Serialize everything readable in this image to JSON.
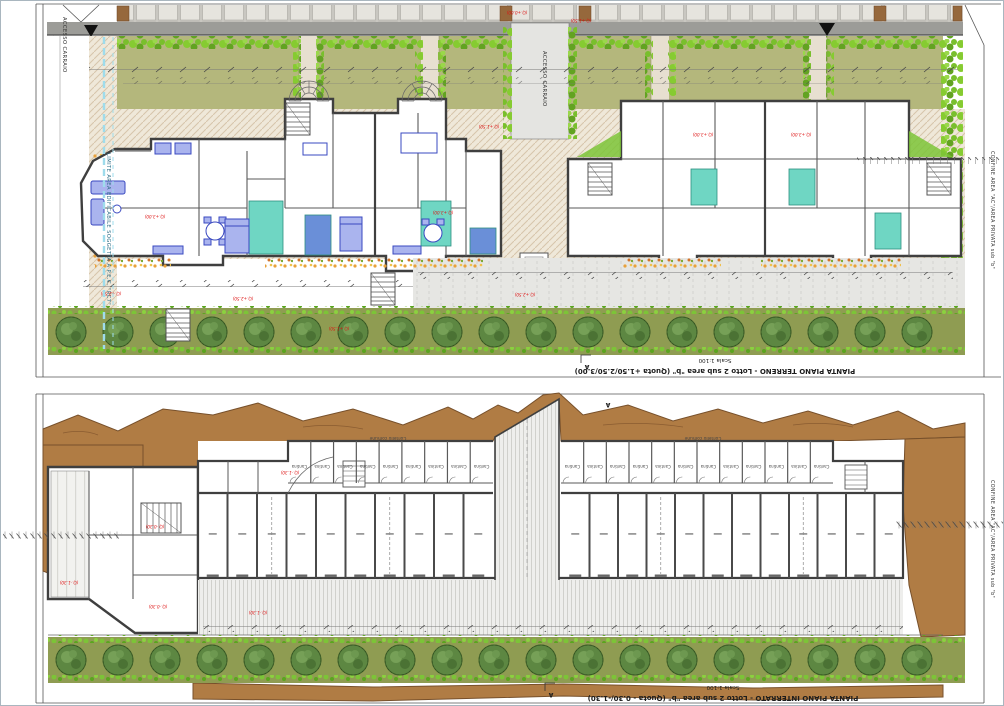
{
  "panels": {
    "top": {
      "title": "PIANTA PIANO TERRENO - Lotto 2 sub area \"b\" (Quota +1.50/2.50/3.00)",
      "scale": "Scala 1:100",
      "section_letter": "A",
      "limit_label": "LIMITE AREA EDIFICABILE SOGGETTA A P.E.C. \"RC7\"",
      "boundary_label": "CONFINE AREA \"AC\"/AREA PRIVATA sub \"b\"",
      "access_left": "ACCESSO CARRAIO",
      "access_center": "ACCESSO CARRAIO",
      "quota_street": "(Q.+0.00)",
      "quota_garden": "(Q.+1.50)",
      "quota_terrace": "(Q.+2.50)",
      "quota_floor": "(Q.+3.00)"
    },
    "bottom": {
      "title": "PIANTA PIANO INTERRATO - Lotto 2 sub area \"b\" (Quota - 0.30/-1.30)",
      "scale": "Scala 1:100",
      "section_letter": "A",
      "boundary_label": "CONFINE AREA \"AC\"/AREA PRIVATA sub \"b\"",
      "cantina_label": "Cantina",
      "corridor_label": "Corsello comune",
      "quota_taverna": "(Q.-0.30)",
      "quota_garage": "(Q.-1.30)"
    },
    "colors": {
      "garden": "#b4b77c",
      "tree_band": "#8f9c52",
      "shrub_green": "#7cc437",
      "tree_green": "#5d8742",
      "road_grey": "#9c9c98",
      "terrain_brown": "#b07c44",
      "bathroom_teal": "#6fd6c3",
      "furniture_blue": "#3a49c0",
      "marker_red": "#dd1111",
      "limit_cyan": "#9fdcec"
    }
  }
}
